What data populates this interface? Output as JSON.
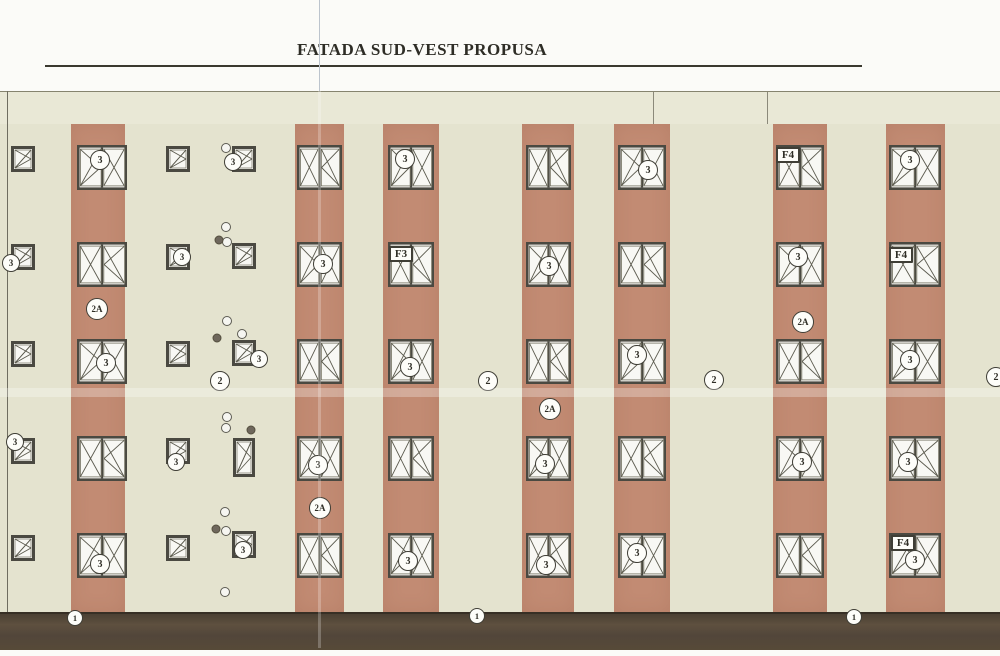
{
  "title": {
    "text": "FATADA SUD-VEST PROPUSA"
  },
  "colors": {
    "paper": "#fbfbf8",
    "wall_top_band": "#e9e8d6",
    "wall": "#e4e3cf",
    "stripe_terracotta": "#c28b73",
    "plinth_brown": "#54483a",
    "window_frame": "#4a4941",
    "window_glass": "#f8f8f4",
    "sash_line": "#5b5a4e",
    "label_ink": "#2f2e26"
  },
  "drawing": {
    "underline": {
      "x1": 45,
      "x2": 862,
      "y": 65
    },
    "fold_line_x": 319,
    "top_band": {
      "y1": 91,
      "y2": 124,
      "joints_x": [
        653,
        767
      ]
    },
    "left_edge_x": 7,
    "plinth": {
      "y1": 612,
      "y2": 648
    },
    "crease_y": 388,
    "rows_y": [
      145,
      242,
      339,
      436,
      533
    ],
    "large_window_height": 45,
    "stripes": [
      {
        "x": 71,
        "w": 54,
        "wx": 77,
        "ww": 50
      },
      {
        "x": 295,
        "w": 49,
        "wx": 297,
        "ww": 45
      },
      {
        "x": 383,
        "w": 56,
        "wx": 388,
        "ww": 46
      },
      {
        "x": 522,
        "w": 52,
        "wx": 526,
        "ww": 45
      },
      {
        "x": 614,
        "w": 56,
        "wx": 618,
        "ww": 48
      },
      {
        "x": 773,
        "w": 54,
        "wx": 776,
        "ww": 48
      },
      {
        "x": 886,
        "w": 59,
        "wx": 889,
        "ww": 52
      }
    ]
  },
  "small_windows": [
    {
      "x": 11,
      "y": 146,
      "w": 24,
      "h": 26
    },
    {
      "x": 11,
      "y": 244,
      "w": 24,
      "h": 26
    },
    {
      "x": 11,
      "y": 341,
      "w": 24,
      "h": 26
    },
    {
      "x": 11,
      "y": 438,
      "w": 24,
      "h": 26
    },
    {
      "x": 11,
      "y": 535,
      "w": 24,
      "h": 26
    },
    {
      "x": 166,
      "y": 146,
      "w": 24,
      "h": 26
    },
    {
      "x": 166,
      "y": 244,
      "w": 24,
      "h": 26
    },
    {
      "x": 166,
      "y": 341,
      "w": 24,
      "h": 26
    },
    {
      "x": 166,
      "y": 438,
      "w": 24,
      "h": 26
    },
    {
      "x": 166,
      "y": 535,
      "w": 24,
      "h": 26
    },
    {
      "x": 232,
      "y": 146,
      "w": 24,
      "h": 26
    },
    {
      "x": 232,
      "y": 243,
      "w": 24,
      "h": 26
    },
    {
      "x": 232,
      "y": 340,
      "w": 24,
      "h": 26
    },
    {
      "x": 233,
      "y": 438,
      "w": 22,
      "h": 39
    },
    {
      "x": 232,
      "y": 531,
      "w": 24,
      "h": 27
    }
  ],
  "annotations": [
    {
      "text": "3",
      "shape": "circle",
      "x": 100,
      "y": 160,
      "d": 20
    },
    {
      "text": "3",
      "shape": "circle",
      "x": 106,
      "y": 363,
      "d": 20
    },
    {
      "text": "3",
      "shape": "circle",
      "x": 100,
      "y": 564,
      "d": 20
    },
    {
      "text": "3",
      "shape": "circle",
      "x": 323,
      "y": 264,
      "d": 20
    },
    {
      "text": "3",
      "shape": "circle",
      "x": 318,
      "y": 465,
      "d": 20
    },
    {
      "text": "3",
      "shape": "circle",
      "x": 405,
      "y": 159,
      "d": 20
    },
    {
      "text": "3",
      "shape": "circle",
      "x": 410,
      "y": 367,
      "d": 20
    },
    {
      "text": "3",
      "shape": "circle",
      "x": 408,
      "y": 561,
      "d": 20
    },
    {
      "text": "3",
      "shape": "circle",
      "x": 549,
      "y": 266,
      "d": 20
    },
    {
      "text": "3",
      "shape": "circle",
      "x": 545,
      "y": 464,
      "d": 20
    },
    {
      "text": "3",
      "shape": "circle",
      "x": 546,
      "y": 565,
      "d": 20
    },
    {
      "text": "3",
      "shape": "circle",
      "x": 648,
      "y": 170,
      "d": 20
    },
    {
      "text": "3",
      "shape": "circle",
      "x": 637,
      "y": 355,
      "d": 20
    },
    {
      "text": "3",
      "shape": "circle",
      "x": 637,
      "y": 553,
      "d": 20
    },
    {
      "text": "3",
      "shape": "circle",
      "x": 798,
      "y": 257,
      "d": 20
    },
    {
      "text": "3",
      "shape": "circle",
      "x": 802,
      "y": 462,
      "d": 20
    },
    {
      "text": "3",
      "shape": "circle",
      "x": 910,
      "y": 160,
      "d": 20
    },
    {
      "text": "3",
      "shape": "circle",
      "x": 910,
      "y": 360,
      "d": 20
    },
    {
      "text": "3",
      "shape": "circle",
      "x": 908,
      "y": 462,
      "d": 20
    },
    {
      "text": "3",
      "shape": "circle",
      "x": 915,
      "y": 560,
      "d": 20
    },
    {
      "text": "3",
      "shape": "circle",
      "x": 11,
      "y": 263,
      "d": 18
    },
    {
      "text": "3",
      "shape": "circle",
      "x": 15,
      "y": 442,
      "d": 18
    },
    {
      "text": "3",
      "shape": "circle",
      "x": 182,
      "y": 257,
      "d": 18
    },
    {
      "text": "3",
      "shape": "circle",
      "x": 176,
      "y": 462,
      "d": 18
    },
    {
      "text": "3",
      "shape": "circle",
      "x": 233,
      "y": 162,
      "d": 18
    },
    {
      "text": "3",
      "shape": "circle",
      "x": 259,
      "y": 359,
      "d": 18
    },
    {
      "text": "3",
      "shape": "circle",
      "x": 243,
      "y": 550,
      "d": 18
    },
    {
      "text": "2A",
      "shape": "circle",
      "x": 97,
      "y": 309,
      "d": 22
    },
    {
      "text": "2A",
      "shape": "circle",
      "x": 320,
      "y": 508,
      "d": 22
    },
    {
      "text": "2A",
      "shape": "circle",
      "x": 550,
      "y": 409,
      "d": 22
    },
    {
      "text": "2A",
      "shape": "circle",
      "x": 803,
      "y": 322,
      "d": 22
    },
    {
      "text": "2",
      "shape": "circle",
      "x": 220,
      "y": 381,
      "d": 20
    },
    {
      "text": "2",
      "shape": "circle",
      "x": 488,
      "y": 381,
      "d": 20
    },
    {
      "text": "2",
      "shape": "circle",
      "x": 714,
      "y": 380,
      "d": 20
    },
    {
      "text": "2",
      "shape": "circle",
      "x": 996,
      "y": 377,
      "d": 20
    },
    {
      "text": "1",
      "shape": "circle",
      "x": 75,
      "y": 618,
      "d": 16
    },
    {
      "text": "1",
      "shape": "circle",
      "x": 477,
      "y": 616,
      "d": 16
    },
    {
      "text": "1",
      "shape": "circle",
      "x": 854,
      "y": 617,
      "d": 16
    },
    {
      "text": "F3",
      "shape": "box",
      "x": 401,
      "y": 254,
      "w": 24,
      "h": 16
    },
    {
      "text": "F4",
      "shape": "box",
      "x": 788,
      "y": 155,
      "w": 24,
      "h": 16
    },
    {
      "text": "F4",
      "shape": "box",
      "x": 901,
      "y": 255,
      "w": 24,
      "h": 16
    },
    {
      "text": "F4",
      "shape": "box",
      "x": 903,
      "y": 543,
      "w": 24,
      "h": 16
    }
  ],
  "dots": {
    "light": [
      [
        226,
        148
      ],
      [
        226,
        227
      ],
      [
        227,
        242
      ],
      [
        227,
        321
      ],
      [
        242,
        334
      ],
      [
        227,
        417
      ],
      [
        226,
        428
      ],
      [
        225,
        512
      ],
      [
        226,
        531
      ],
      [
        225,
        592
      ]
    ],
    "dark": [
      [
        219,
        240
      ],
      [
        217,
        338
      ],
      [
        251,
        430
      ],
      [
        216,
        529
      ]
    ]
  }
}
